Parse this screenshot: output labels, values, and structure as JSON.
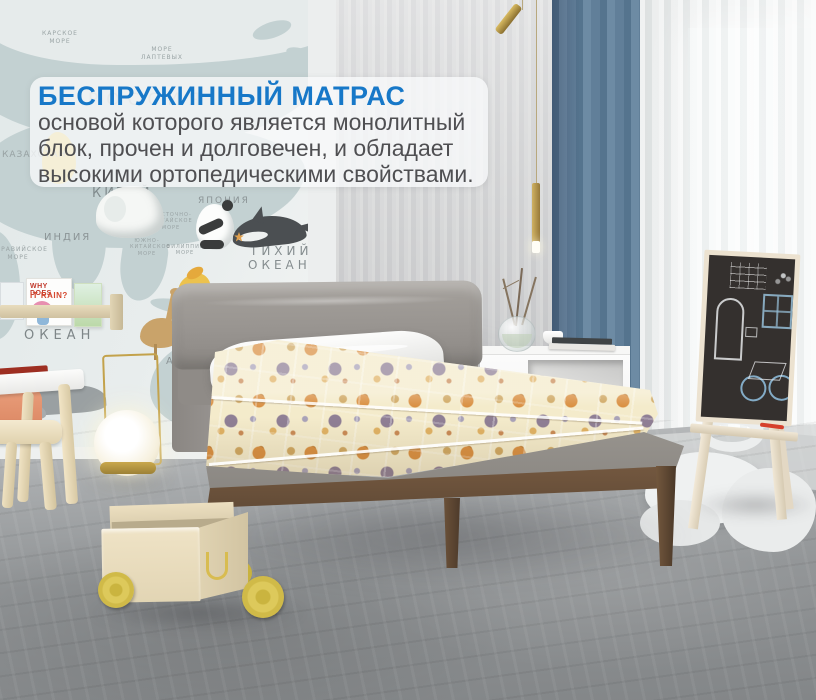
{
  "overlay": {
    "title": "БЕСПРУЖИННЫЙ МАТРАС",
    "title_color": "#1778c8",
    "body_color": "#4f4f52",
    "body_lines": [
      "основой которого является монолитный",
      "блок, прочен и долговечен, и обладает",
      "высокими ортопедическими свойствами."
    ]
  },
  "map_wall": {
    "country_labels": [
      "РОССИЯ",
      "КАЗАХСТАН",
      "КИТАЙ",
      "ИНДИЯ",
      "ЯПОНИЯ",
      "АВСТРАЛИЯ"
    ],
    "sea_labels": [
      "КАРСКОЕ МОРЕ",
      "МОРЕ ЛАПТЕВЫХ",
      "АРАВИЙСКОЕ МОРЕ",
      "ВОСТОЧНО-КИТАЙСКОЕ МОРЕ",
      "ЮЖНО-КИТАЙСКОЕ МОРЕ",
      "ФИЛИППИНСКОЕ МОРЕ"
    ],
    "ocean_labels": {
      "pacific_line1": "ТИХИЙ",
      "pacific_line2": "ОКЕАН",
      "indian_partial": "ИНДИЙСКИЙ",
      "indian_ocean": "ОКЕАН"
    },
    "illustrations": [
      "elephant",
      "panda",
      "orca",
      "emu",
      "shark",
      "whale",
      "giraffe",
      "bird",
      "starfish"
    ]
  },
  "shelf": {
    "book_cover_line1": "WHY DOES",
    "book_cover_line2": "IT RAIN?"
  },
  "colors": {
    "accent_blue": "#1778c8",
    "curtain_blue": "#617f99",
    "mattress_cream": "#f4ebcb",
    "pattern_orange": "#d98f41",
    "pattern_plum": "#8f7f95",
    "bed_wood": "#6e543d",
    "platform_gray": "#908d89",
    "wheel_yellow": "#ddc95b",
    "cart_wood": "#eadec1",
    "lamp_brass": "#c3a24b",
    "chalkboard": "#34302e",
    "floor_gray": "#8c8f91"
  }
}
